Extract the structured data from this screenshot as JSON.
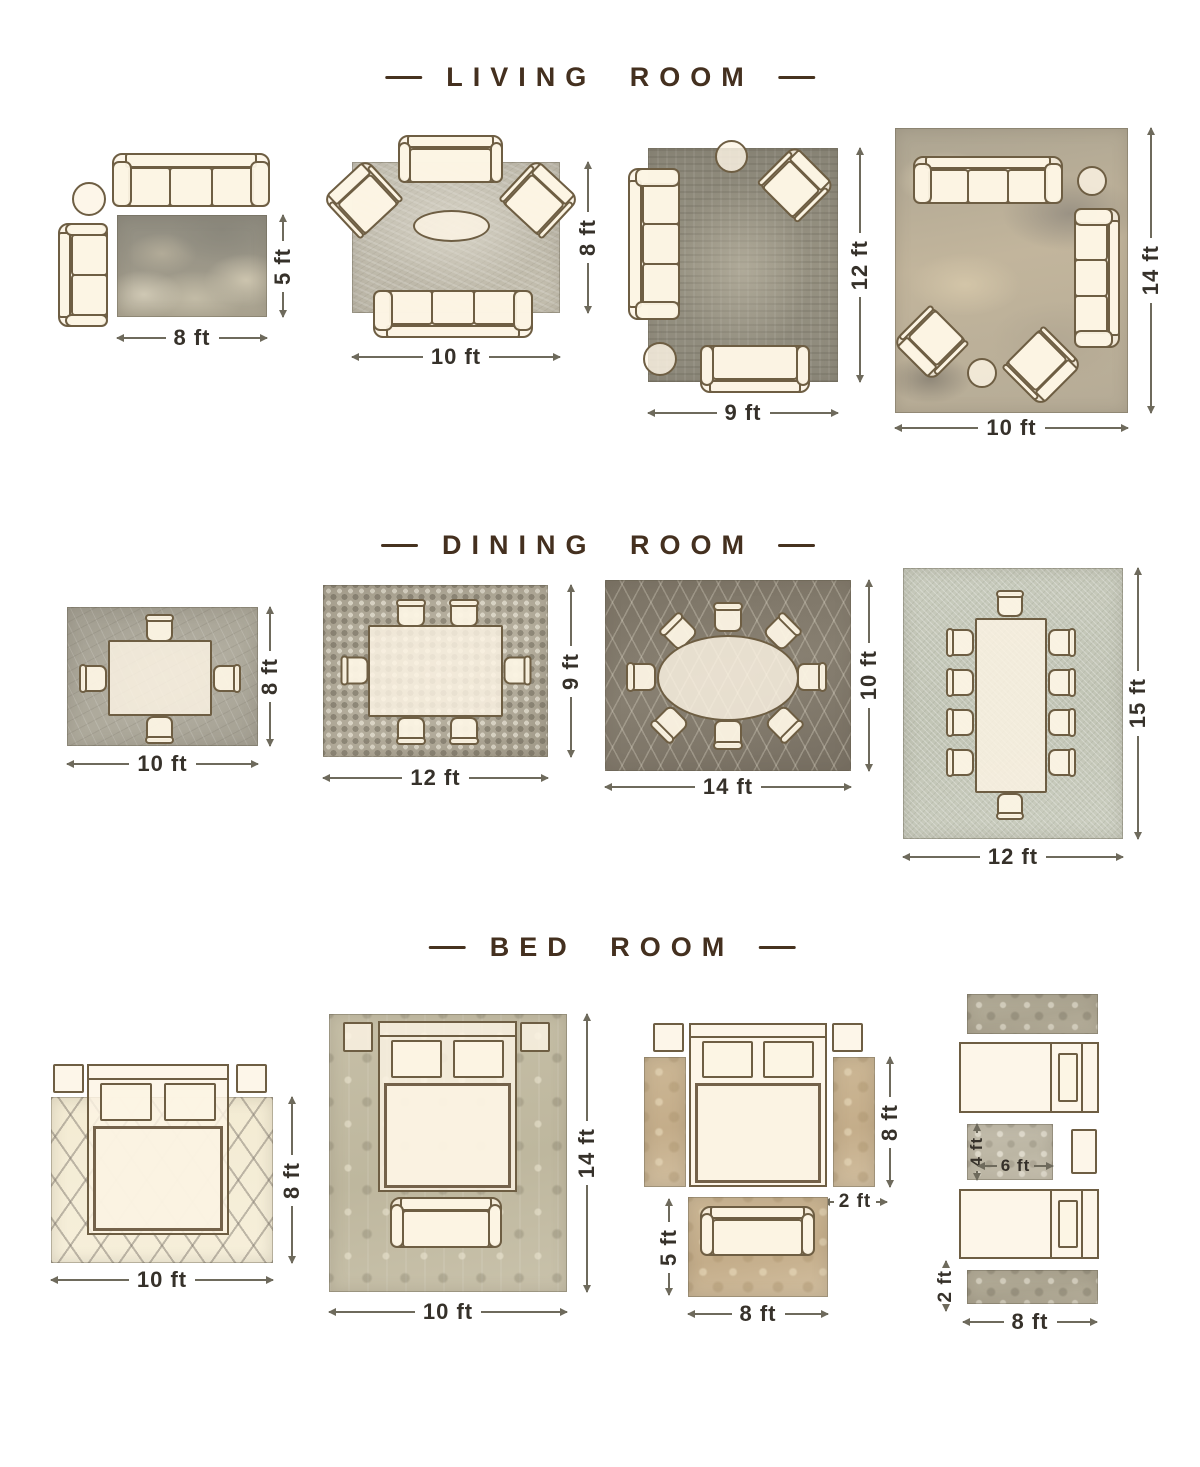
{
  "page": {
    "background": "#ffffff"
  },
  "colors": {
    "title_text": "#44301f",
    "dimension_text": "#36312a",
    "dimension_line": "#6e6a5c",
    "furniture_fill": "#fcf4e4",
    "furniture_outline": "#6e5e43"
  },
  "sections": [
    {
      "id": "living-room",
      "title": "LIVING ROOM",
      "layouts": [
        {
          "name": "living-rug-8x5",
          "width_label": "8 ft",
          "height_label": "5 ft"
        },
        {
          "name": "living-rug-10x8",
          "width_label": "10 ft",
          "height_label": "8 ft"
        },
        {
          "name": "living-rug-9x12",
          "width_label": "9 ft",
          "height_label": "12 ft"
        },
        {
          "name": "living-rug-10x14",
          "width_label": "10 ft",
          "height_label": "14 ft"
        }
      ]
    },
    {
      "id": "dining-room",
      "title": "DINING ROOM",
      "layouts": [
        {
          "name": "dining-rug-10x8",
          "width_label": "10 ft",
          "height_label": "8 ft"
        },
        {
          "name": "dining-rug-12x9",
          "width_label": "12 ft",
          "height_label": "9 ft"
        },
        {
          "name": "dining-rug-14x10",
          "width_label": "14 ft",
          "height_label": "10 ft"
        },
        {
          "name": "dining-rug-12x15",
          "width_label": "12 ft",
          "height_label": "15 ft"
        }
      ]
    },
    {
      "id": "bed-room",
      "title": "BED ROOM",
      "layouts": [
        {
          "name": "bed-rug-10x8",
          "width_label": "10 ft",
          "height_label": "8 ft"
        },
        {
          "name": "bed-rug-10x14",
          "width_label": "10 ft",
          "height_label": "14 ft"
        },
        {
          "name": "bed-side-runners",
          "runner_height_label": "8 ft",
          "runner_width_label": "2 ft",
          "foot_rug_height_label": "5 ft",
          "foot_rug_width_label": "8 ft"
        },
        {
          "name": "twin-beds-runners",
          "mid_rug_height_label": "4 ft",
          "mid_rug_width_label": "6 ft",
          "runner_width_label": "2 ft",
          "width_label": "8 ft"
        }
      ]
    }
  ]
}
